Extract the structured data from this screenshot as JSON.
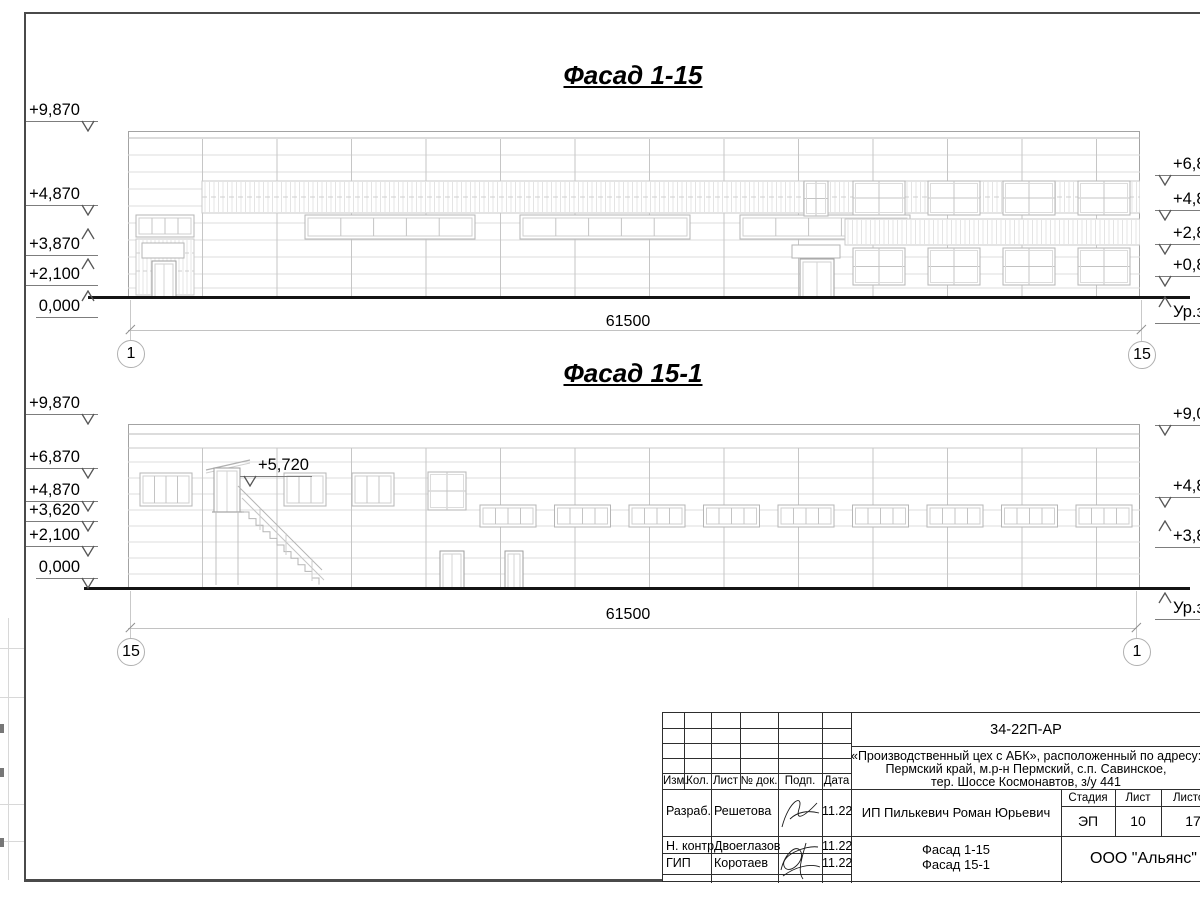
{
  "drawing": {
    "facade1": {
      "title": "Фасад 1-15",
      "dim": "61500",
      "axis_left": "1",
      "axis_right": "15",
      "marks_left": [
        "+9,870",
        "+4,870",
        "+3,870",
        "+2,100",
        "0,000"
      ],
      "marks_right": [
        "+6,870",
        "+4,870",
        "+2,870",
        "+0,870"
      ],
      "ground_label": "Ур.земли"
    },
    "facade2": {
      "title": "Фасад 15-1",
      "dim": "61500",
      "axis_left": "15",
      "axis_right": "1",
      "marks_left": [
        "+9,870",
        "+6,870",
        "+4,870",
        "+3,620",
        "+2,100",
        "0,000"
      ],
      "marks_right": [
        "+9,050",
        "+4,870",
        "+3,870"
      ],
      "annotation": "+5,720",
      "ground_label": "Ур.земли"
    }
  },
  "stamp": {
    "doc_code": "34-22П-АР",
    "project_line1": "«Производственный цех с АБК», расположенный по адресу:",
    "project_line2": "Пермский край, м.р-н Пермский, с.п. Савинское,",
    "project_line3": "тер. Шоссе Космонавтов, з/у 441",
    "col_izm": "Изм.",
    "col_kol": "Кол.",
    "col_list": "Лист",
    "col_doc": "№ док.",
    "col_podp": "Подп.",
    "col_data": "Дата",
    "row1_role": "Разраб.",
    "row1_name": "Решетова",
    "row1_date": "11.22",
    "row2_role": "Н. контр.",
    "row2_name": "Двоеглазов",
    "row2_date": "11.22",
    "row3_role": "ГИП",
    "row3_name": "Коротаев",
    "row3_date": "11.22",
    "client": "ИП Пилькевич Роман Юрьевич",
    "stage_label": "Стадия",
    "list_label": "Лист",
    "listov_label": "Листов",
    "stage": "ЭП",
    "list": "10",
    "listov": "17",
    "sheet_title_line1": "Фасад 1-15",
    "sheet_title_line2": "Фасад 15-1",
    "org": "ООО \"Альянс\""
  }
}
